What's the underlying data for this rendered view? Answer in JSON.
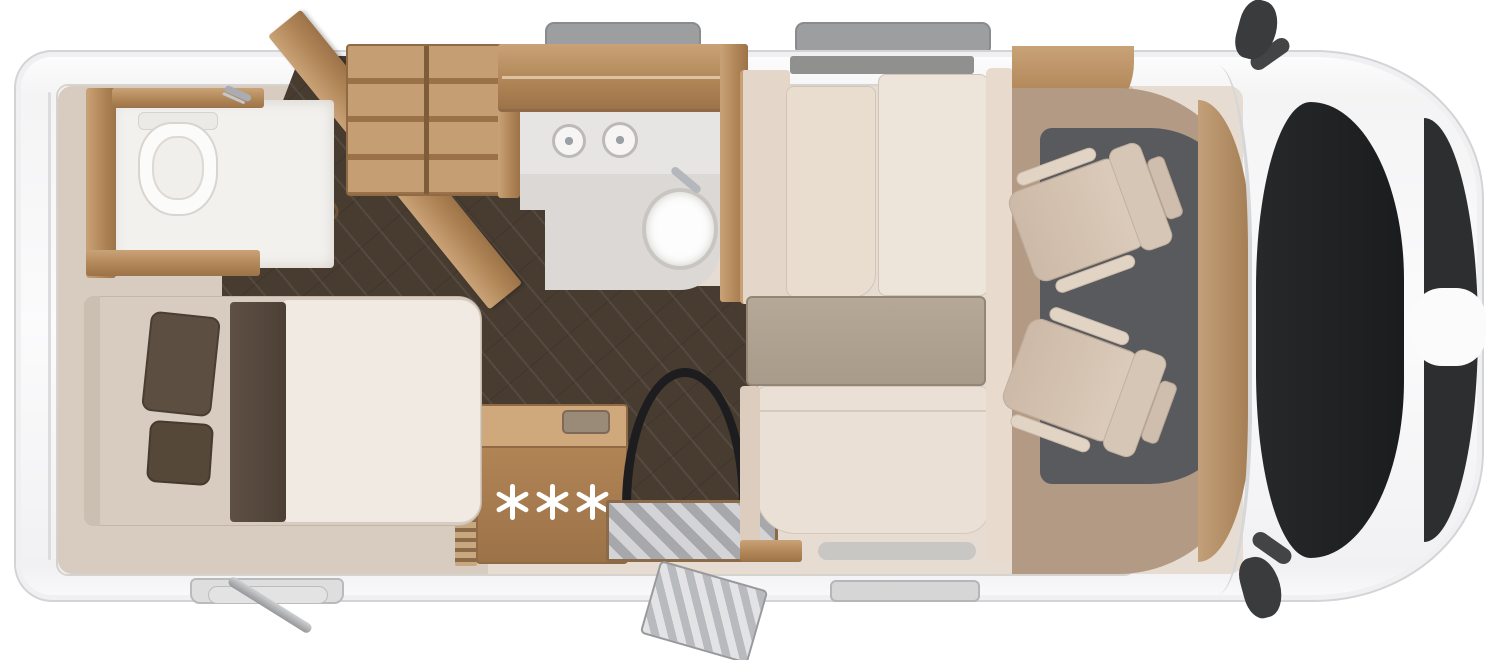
{
  "page": {
    "background_color": "#ffffff",
    "content": "motorhome floor plan, top-down view, cab and windshield at the right (front), bedroom at the left (rear)"
  },
  "vehicle": {
    "body_color": "#fbfbfc",
    "outline_color": "#d3d4d6",
    "windshield_color": "#1d1f21",
    "front_grille_color": "#2c2e30",
    "mirror_color": "#3a3b3d",
    "mirrors": [
      "top-side-mirror",
      "bottom-side-mirror"
    ],
    "roof_window_tabs_top": 2,
    "window_tabs_bottom": [
      "bedroom-window",
      "dinette-window"
    ],
    "exterior_features": [
      "entry-step",
      "exterior-folding-step",
      "rear-support-jack"
    ]
  },
  "interior": {
    "floor_light_color": "#e6dcd1",
    "floor_dark_color": "#483c31",
    "wood_color": "#b18758",
    "bedroom_rear_left": {
      "bed": {
        "pillow_count": 2,
        "pillow_color": "#5c4e41",
        "mattress_colors": [
          "#d8ccc0",
          "#f0eae2"
        ],
        "runner_color": "#55493c"
      }
    },
    "toilet_room_rear": {
      "fixtures": [
        "toilet",
        "shower-fitting"
      ],
      "partition": "diagonal-wood-wall-with-handle"
    },
    "wardrobe": {
      "location": "between toilet room and washroom",
      "shelves": true
    },
    "washroom_center": {
      "fixtures": [
        "overhead-cabinet",
        "counter",
        "shower-control-dials",
        "round-washbasin",
        "chrome-faucet"
      ]
    },
    "kitchen": {
      "burner_count": 3,
      "burner_symbol": "eight-spoked-asterisk",
      "features": [
        "three-burner-hob",
        "recessed-sink",
        "ribbed-side-panel"
      ]
    },
    "entry": {
      "features": [
        "black-door-swing-arc",
        "striped-metal-step"
      ]
    },
    "dinette": {
      "features": [
        "rear-bench-two-cushions",
        "table",
        "front-bench",
        "side-panel",
        "window-band"
      ],
      "table_color": "#b0a392",
      "cushion_color": "#e9ddd0"
    },
    "cab": {
      "seats": [
        {
          "name": "driver-swivel-seat",
          "facing": "living-area"
        },
        {
          "name": "passenger-swivel-seat",
          "facing": "living-area"
        }
      ],
      "floor_mat_color": "#b29a84",
      "floor_dark_color": "#595a5e",
      "dashboard_color": "#b3895e"
    }
  }
}
